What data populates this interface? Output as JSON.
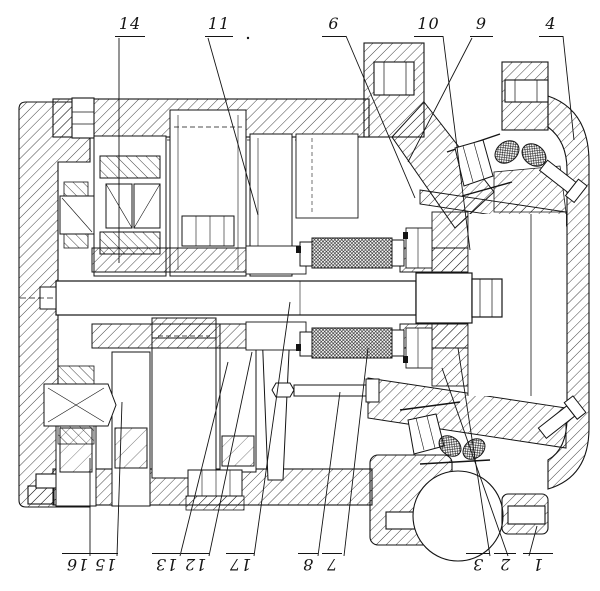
{
  "colors": {
    "ink": "#141414",
    "paper": "#ffffff"
  },
  "drawing": {
    "kind": "sectional engineering drawing"
  },
  "callouts": {
    "top": [
      "14",
      "11",
      "6",
      "10",
      "9",
      "4"
    ],
    "bottom": [
      "16",
      "15",
      "13",
      "12",
      "17",
      "8",
      "7",
      "3",
      "2",
      "1"
    ]
  }
}
